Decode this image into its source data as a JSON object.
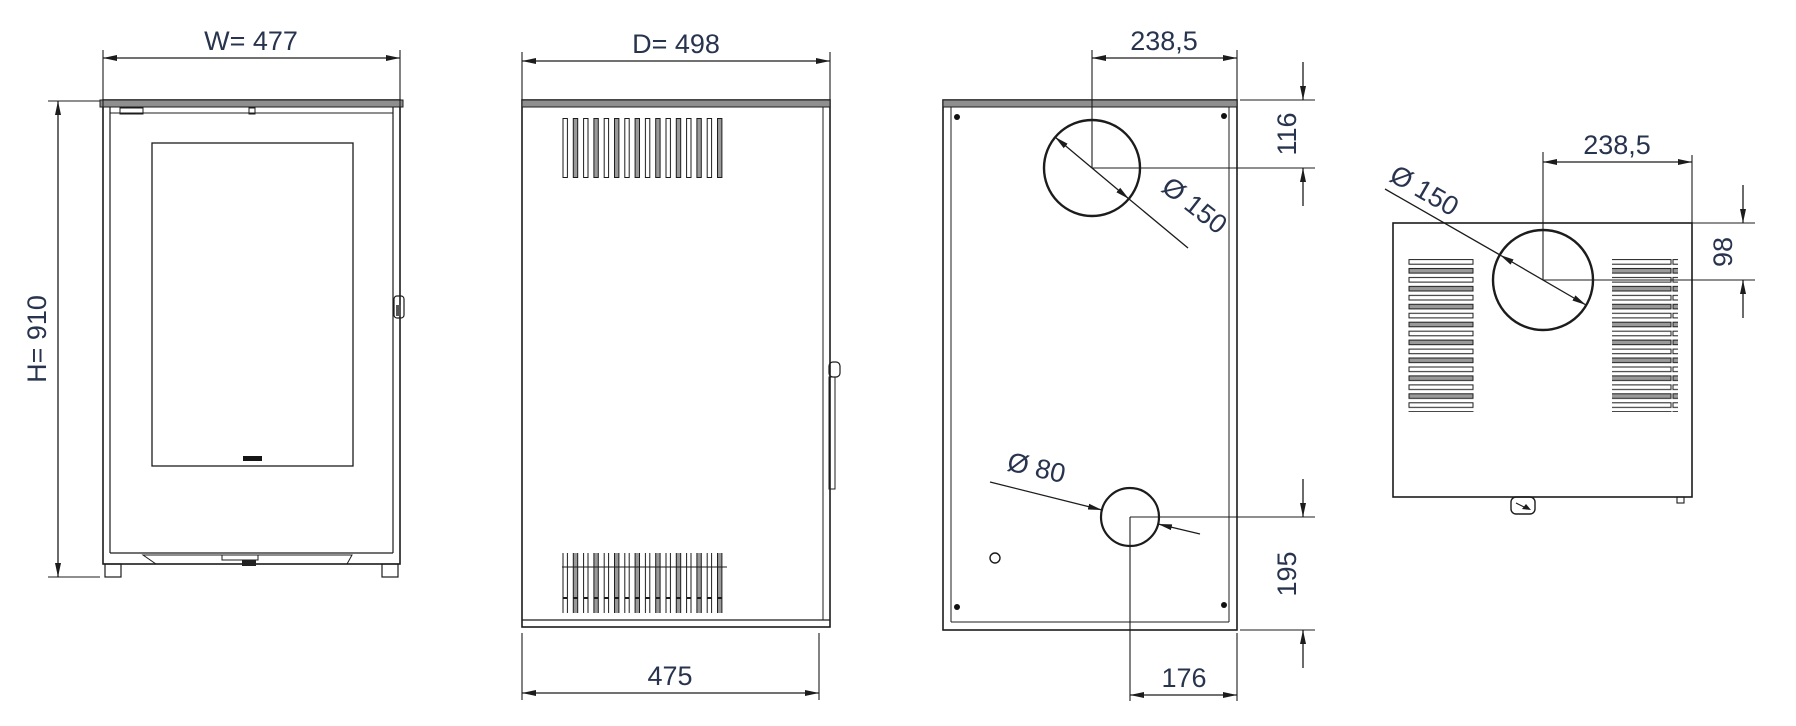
{
  "page": {
    "type": "technical-drawing",
    "subject": "Freestanding stove dimensional drawing with four orthographic views (front, side, back, top)",
    "background": "#ffffff"
  },
  "colors": {
    "line": "#1c1c1c",
    "dimension_text": "#28344e",
    "band_fill": "#8f8f8f",
    "slat_fill": "#9a9a9a"
  },
  "views": {
    "front": {
      "label": "front view",
      "dim_width": "W= 477",
      "dim_height": "H= 910"
    },
    "side": {
      "label": "side view",
      "dim_depth": "D= 498",
      "dim_base_depth": "475"
    },
    "back": {
      "label": "back view",
      "dim_offset_x": "238,5",
      "dim_offset_y": "116",
      "dim_flue": "Ø 150",
      "dim_inlet": "Ø 80",
      "dim_inlet_y": "195",
      "dim_inlet_x": "176"
    },
    "top": {
      "label": "top view",
      "dim_flue": "Ø 150",
      "dim_offset_x": "238,5",
      "dim_offset_y": "98"
    }
  }
}
